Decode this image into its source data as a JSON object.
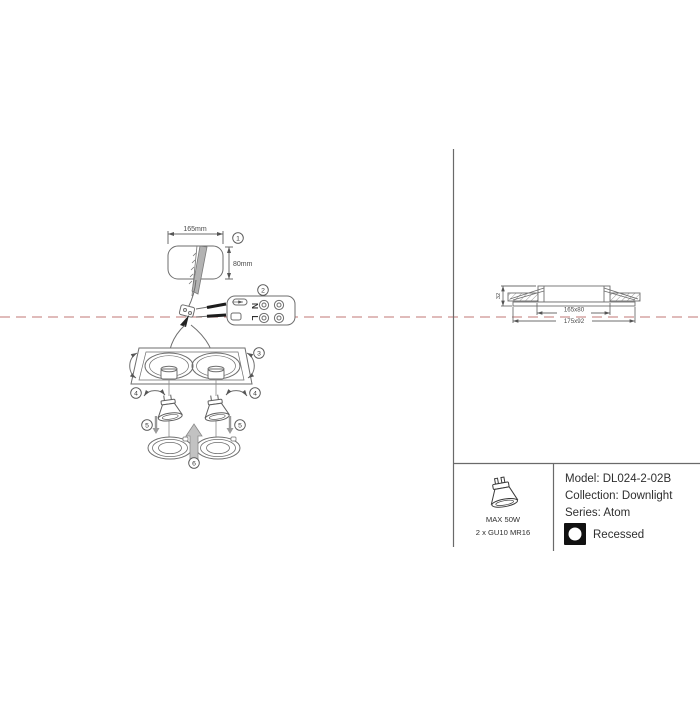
{
  "colors": {
    "ceiling_line": "#c5807e",
    "line_art": "#6e6e6e",
    "text": "#2f2f2f",
    "badge_bg": "#111111"
  },
  "installation": {
    "dim_width": "165mm",
    "dim_height": "80mm",
    "terminal_top": "N",
    "terminal_bottom": "L",
    "steps": [
      "1",
      "2",
      "3",
      "4",
      "5",
      "6"
    ]
  },
  "section_view": {
    "height_dim": "32",
    "cutout_dim": "165x80",
    "overall_dim": "175x92"
  },
  "spec_panel": {
    "max_wattage": "MAX 50W",
    "lamp_type": "2 x GU10 MR16",
    "model_line": "Model: DL024-2-02B",
    "collection_line": "Collection: Downlight",
    "series_line": "Series: Atom",
    "mounting_label": "Recessed"
  }
}
